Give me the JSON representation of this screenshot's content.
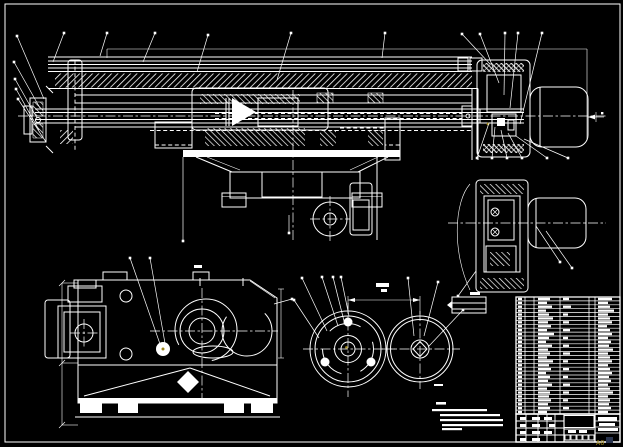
{
  "meta": {
    "type": "cad-assembly-engineering-drawing",
    "background": "#000000",
    "line_color": "#ffffff",
    "accent_color": "#9c8419",
    "corner_mark_color": "#2a3550",
    "sheet_mark": "A0"
  },
  "views": {
    "main": "main-assembly-longitudinal-section",
    "end": "right-end-view-with-motor",
    "gearbox": "gearbox-side-view",
    "handwheel": "handwheel-front-view",
    "wheel": "plain-wheel-front-view"
  },
  "parts_table": {
    "x": 516,
    "y": 297,
    "width": 104,
    "rows": 30,
    "row_height": 3.9,
    "col_widths": [
      9,
      9,
      26,
      29,
      6,
      25
    ],
    "blob_cols": {
      "c1": 518,
      "c3": 538,
      "c4": 563,
      "c6": 598
    },
    "row_blobs": [
      [
        4,
        12,
        6,
        14
      ],
      [
        4,
        9,
        0,
        10
      ],
      [
        4,
        14,
        8,
        12
      ],
      [
        4,
        8,
        0,
        16
      ],
      [
        4,
        11,
        5,
        10
      ],
      [
        4,
        15,
        0,
        12
      ],
      [
        4,
        10,
        6,
        14
      ],
      [
        4,
        13,
        0,
        9
      ],
      [
        4,
        9,
        7,
        12
      ],
      [
        4,
        16,
        0,
        14
      ],
      [
        4,
        11,
        5,
        10
      ],
      [
        4,
        8,
        0,
        13
      ],
      [
        4,
        14,
        6,
        11
      ],
      [
        4,
        10,
        0,
        15
      ],
      [
        4,
        12,
        7,
        10
      ],
      [
        4,
        9,
        0,
        12
      ],
      [
        4,
        15,
        5,
        14
      ],
      [
        4,
        11,
        0,
        10
      ],
      [
        4,
        13,
        6,
        12
      ],
      [
        4,
        8,
        0,
        14
      ],
      [
        4,
        12,
        5,
        11
      ],
      [
        4,
        10,
        0,
        13
      ],
      [
        4,
        14,
        7,
        10
      ],
      [
        4,
        9,
        0,
        12
      ],
      [
        4,
        12,
        6,
        15
      ],
      [
        4,
        11,
        0,
        10
      ],
      [
        4,
        13,
        5,
        12
      ],
      [
        4,
        10,
        0,
        11
      ],
      [
        4,
        12,
        6,
        13
      ],
      [
        4,
        9,
        0,
        10
      ]
    ]
  },
  "title_block": {
    "x": 516,
    "y": 414,
    "width": 104,
    "height": 28,
    "sig_cols": [
      10,
      12,
      9,
      8,
      9
    ],
    "sig_rows": 4,
    "number_box": [
      564,
      415.5,
      30,
      12
    ],
    "strip_boxes": 5,
    "blobs": [
      [
        520,
        417,
        6,
        3
      ],
      [
        532,
        417,
        8,
        3
      ],
      [
        544,
        417,
        8,
        3
      ],
      [
        520,
        424,
        6,
        3
      ],
      [
        532,
        424,
        8,
        3
      ],
      [
        549,
        424,
        6,
        3
      ],
      [
        520,
        431,
        6,
        3
      ],
      [
        532,
        431,
        8,
        3
      ],
      [
        544,
        431,
        8,
        3
      ],
      [
        520,
        438,
        6,
        3
      ],
      [
        532,
        438,
        8,
        3
      ],
      [
        568,
        430,
        8,
        3
      ],
      [
        579,
        430,
        8,
        3
      ],
      [
        598,
        417,
        19,
        4
      ],
      [
        599,
        423,
        16,
        3
      ],
      [
        598,
        428,
        20,
        3
      ]
    ]
  },
  "tech_notes": {
    "heading": [
      436,
      402,
      10,
      3
    ],
    "marker": [
      434,
      384,
      9,
      2
    ],
    "lines": [
      [
        432,
        409,
        55
      ],
      [
        440,
        414,
        60
      ],
      [
        440,
        419,
        63
      ],
      [
        442,
        424,
        61
      ],
      [
        442,
        428,
        20
      ]
    ]
  },
  "misc_blobs": [
    [
      376,
      283,
      13,
      4
    ],
    [
      381,
      289,
      6,
      3
    ],
    [
      194,
      265,
      8,
      3
    ],
    [
      470,
      292,
      10,
      3
    ]
  ],
  "callouts": {
    "dot_size": 2.6,
    "groups": [
      {
        "name": "top-fan",
        "dots": [
          [
            64,
            33
          ],
          [
            107,
            33
          ],
          [
            155,
            33
          ],
          [
            208,
            35
          ],
          [
            291,
            33
          ],
          [
            385,
            33
          ]
        ],
        "targets": [
          [
            53,
            62
          ],
          [
            100,
            56
          ],
          [
            143,
            62
          ],
          [
            197,
            72
          ],
          [
            277,
            80
          ],
          [
            382,
            58
          ]
        ]
      },
      {
        "name": "left-fan",
        "dots": [
          [
            17,
            36
          ],
          [
            14,
            62
          ],
          [
            15,
            79
          ],
          [
            16,
            89
          ],
          [
            18,
            99
          ]
        ],
        "targets": [
          [
            44,
            99
          ],
          [
            40,
            108
          ],
          [
            37,
            118
          ],
          [
            39,
            130
          ],
          [
            46,
            142
          ]
        ]
      },
      {
        "name": "right-top-fan",
        "dots": [
          [
            462,
            34
          ],
          [
            480,
            34
          ],
          [
            505,
            33
          ],
          [
            518,
            33
          ],
          [
            542,
            33
          ]
        ],
        "targets": [
          [
            490,
            64
          ],
          [
            499,
            83
          ],
          [
            504,
            95
          ],
          [
            510,
            108
          ],
          [
            520,
            124
          ]
        ]
      },
      {
        "name": "right-mid-fan",
        "dots": [
          [
            477,
            158
          ],
          [
            492,
            158
          ],
          [
            507,
            158
          ],
          [
            522,
            158
          ],
          [
            547,
            158
          ],
          [
            568,
            158
          ]
        ],
        "targets": [
          [
            489,
            123
          ],
          [
            495,
            127
          ],
          [
            501,
            130
          ],
          [
            508,
            133
          ],
          [
            516,
            136
          ],
          [
            524,
            139
          ]
        ]
      },
      {
        "name": "end-view-leaders",
        "dots": [
          [
            560,
            262
          ],
          [
            572,
            268
          ],
          [
            458,
            296
          ]
        ],
        "targets": [
          [
            536,
            226
          ],
          [
            546,
            231
          ],
          [
            476,
            271
          ]
        ]
      },
      {
        "name": "wheel-leaders",
        "dots": [
          [
            302,
            278
          ],
          [
            322,
            277
          ],
          [
            333,
            277
          ],
          [
            341,
            277
          ],
          [
            294,
            300
          ],
          [
            463,
            310
          ],
          [
            438,
            282
          ],
          [
            408,
            278
          ]
        ],
        "targets": [
          [
            327,
            331
          ],
          [
            338,
            326
          ],
          [
            344,
            321
          ],
          [
            349,
            316
          ],
          [
            319,
            338
          ],
          [
            429,
            346
          ],
          [
            424,
            336
          ],
          [
            414,
            336
          ]
        ]
      },
      {
        "name": "gearbox-leaders",
        "dots": [
          [
            130,
            258
          ],
          [
            150,
            258
          ],
          [
            292,
            299
          ]
        ],
        "targets": [
          [
            160,
            344
          ],
          [
            166,
            349
          ],
          [
            274,
            304
          ]
        ]
      },
      {
        "name": "saddle-leaders",
        "dots": [
          [
            183,
            241
          ],
          [
            289,
            233
          ]
        ],
        "targets": [
          [
            183,
            157
          ],
          [
            289,
            215
          ]
        ]
      }
    ]
  }
}
